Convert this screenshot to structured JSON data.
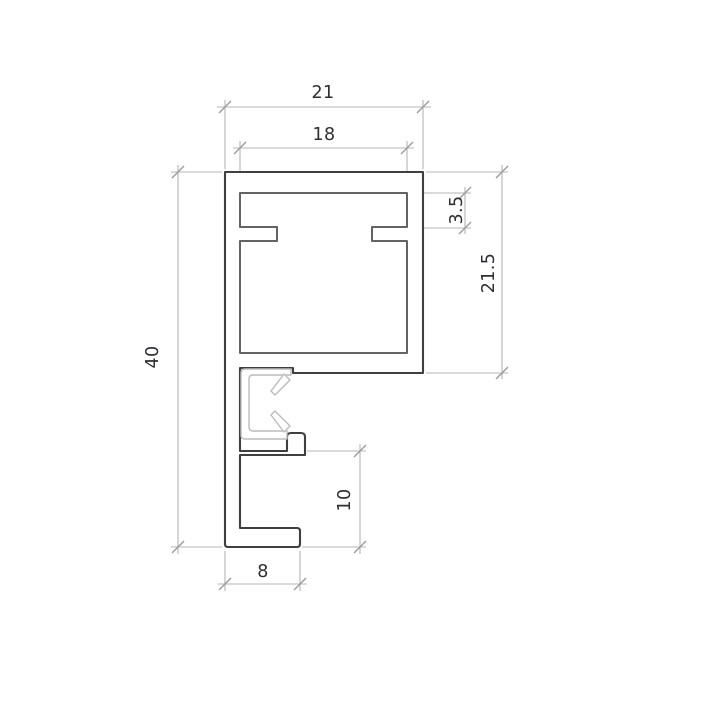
{
  "drawing": {
    "kind": "technical-cross-section-profile",
    "dimensions": [
      {
        "id": "outer-width-top",
        "label": "21",
        "orientation": "horizontal"
      },
      {
        "id": "inner-width-top",
        "label": "18",
        "orientation": "horizontal"
      },
      {
        "id": "groove-depth",
        "label": "3.5",
        "orientation": "vertical"
      },
      {
        "id": "top-box-height",
        "label": "21.5",
        "orientation": "vertical"
      },
      {
        "id": "total-height",
        "label": "40",
        "orientation": "vertical"
      },
      {
        "id": "bottom-channel-height",
        "label": "10",
        "orientation": "vertical"
      },
      {
        "id": "bottom-width",
        "label": "8",
        "orientation": "horizontal"
      }
    ],
    "colors": {
      "profile_outline": "#3f3f41",
      "inner_cavity_outline": "#636363",
      "insert_clip_outline": "#bcbcbc",
      "dimension_lines": "#b5b5b5",
      "tick_marks": "#9c9c9c",
      "dimension_text": "#2e2e33",
      "background": "#ffffff"
    }
  }
}
